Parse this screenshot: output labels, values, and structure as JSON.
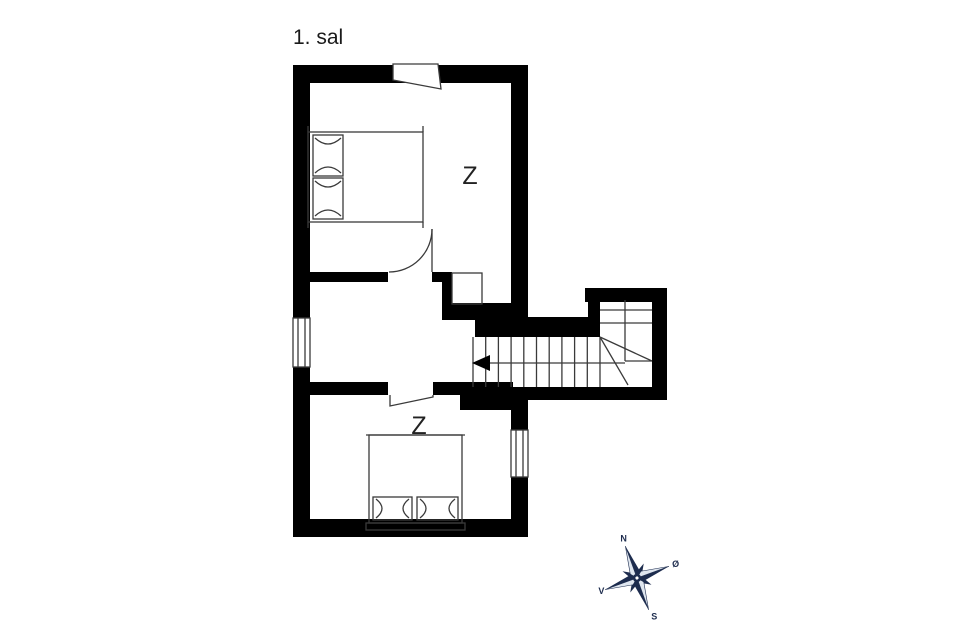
{
  "title": "1. sal",
  "rooms": {
    "upper_bedroom_label": "Z",
    "lower_bedroom_label": "Z"
  },
  "compass": {
    "north": "N",
    "east": "Ø",
    "south": "S",
    "west": "V"
  },
  "colors": {
    "wall": "#000000",
    "thin_line": "#3a3a3a",
    "compass_navy": "#1d2c4e",
    "compass_light": "#dfe6ef",
    "background": "#ffffff"
  }
}
